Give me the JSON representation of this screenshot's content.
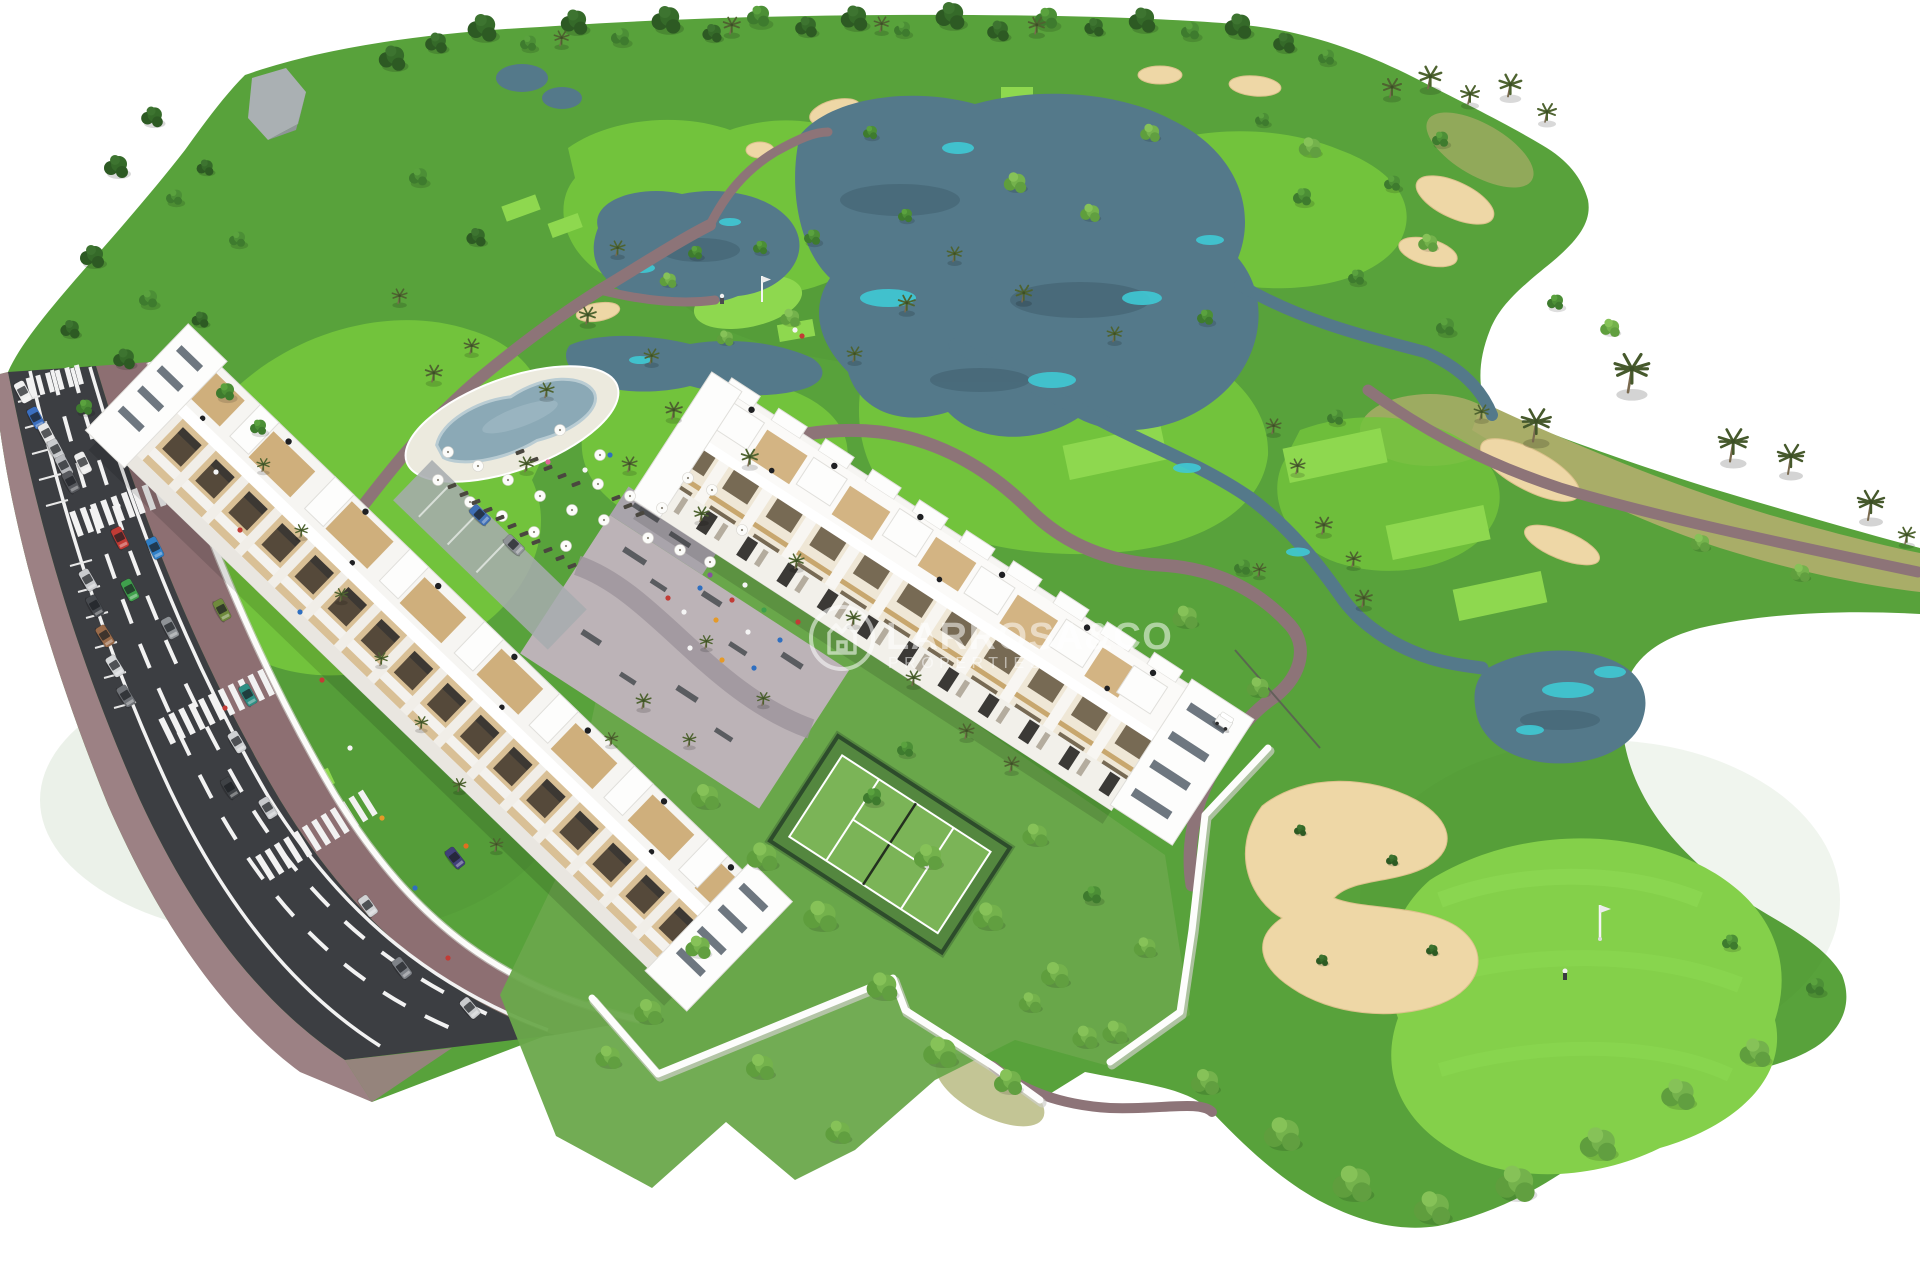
{
  "watermark": {
    "title": "LARROSA&CO",
    "subtitle": "PROPERTIES",
    "logo": "house-crown-circle-icon"
  },
  "palette": {
    "bg": "#ffffff",
    "rough": "#58a23b",
    "fairway": "#72c33c",
    "fairway2": "#84d04a",
    "tee": "#8ed84f",
    "dry": "#a9ad68",
    "water": "#54798a",
    "waterDeep": "#3c5a68",
    "cyan": "#3fc9d4",
    "sand": "#eed7a6",
    "sandEdge": "#dcc28c",
    "path": "#8d7478",
    "road": "#3c3e42",
    "roadLine": "#f2f2f2",
    "sidewalk": "#9c8184",
    "sidewalk2": "#8d6f72",
    "white": "#f6f5f2",
    "wood": "#cba76f",
    "garden": "#6aa84b",
    "playground": "#bcb3b7",
    "court": "#7bb457",
    "fence": "#2d4c2b",
    "wall": "#fdfdfc",
    "treeDark": "#2d5a23",
    "treeMid": "#3e7b2e",
    "treeLight": "#74b24c",
    "palm": "#4e6330",
    "pool": "#8ba9b6",
    "poolDeck": "#eceade"
  },
  "scene": {
    "trees": [
      [
        392,
        62,
        1.1,
        "t1"
      ],
      [
        436,
        46,
        0.9,
        "t1"
      ],
      [
        482,
        32,
        1.2,
        "t1"
      ],
      [
        528,
        46,
        0.8,
        "t2"
      ],
      [
        574,
        26,
        1.1,
        "t1"
      ],
      [
        620,
        40,
        0.9,
        "t2"
      ],
      [
        666,
        24,
        1.2,
        "t1"
      ],
      [
        712,
        36,
        0.8,
        "t1"
      ],
      [
        758,
        20,
        1.1,
        "t2"
      ],
      [
        806,
        30,
        0.9,
        "t1"
      ],
      [
        854,
        22,
        1.1,
        "t1"
      ],
      [
        902,
        32,
        0.8,
        "t2"
      ],
      [
        950,
        20,
        1.2,
        "t1"
      ],
      [
        998,
        34,
        0.9,
        "t1"
      ],
      [
        1046,
        22,
        1.1,
        "t2"
      ],
      [
        1094,
        30,
        0.8,
        "t1"
      ],
      [
        1142,
        24,
        1.1,
        "t1"
      ],
      [
        1190,
        34,
        0.9,
        "t2"
      ],
      [
        1238,
        30,
        1.1,
        "t1"
      ],
      [
        1284,
        46,
        0.9,
        "t1"
      ],
      [
        1326,
        60,
        0.8,
        "t2"
      ],
      [
        560,
        44,
        0.8,
        "palm"
      ],
      [
        730,
        32,
        0.9,
        "palm"
      ],
      [
        880,
        30,
        0.8,
        "palm"
      ],
      [
        1035,
        32,
        0.9,
        "palm"
      ],
      [
        1390,
        95,
        1.0,
        "palm"
      ],
      [
        1428,
        86,
        1.2,
        "palm"
      ],
      [
        1468,
        102,
        1.0,
        "palm"
      ],
      [
        1508,
        94,
        1.2,
        "palm"
      ],
      [
        1545,
        120,
        1.0,
        "palm"
      ],
      [
        152,
        120,
        0.9,
        "t1"
      ],
      [
        116,
        170,
        1.0,
        "t1"
      ],
      [
        174,
        200,
        0.8,
        "t2"
      ],
      [
        92,
        260,
        1.0,
        "t1"
      ],
      [
        148,
        302,
        0.9,
        "t2"
      ],
      [
        70,
        332,
        0.8,
        "t1"
      ],
      [
        124,
        362,
        0.9,
        "t1"
      ],
      [
        84,
        410,
        0.8,
        "t2"
      ],
      [
        205,
        170,
        0.7,
        "t1"
      ],
      [
        237,
        242,
        0.8,
        "t2"
      ],
      [
        200,
        322,
        0.7,
        "t1"
      ],
      [
        418,
        180,
        0.9,
        "t2"
      ],
      [
        476,
        240,
        0.8,
        "t1"
      ],
      [
        398,
        302,
        0.8,
        "palm"
      ],
      [
        616,
        254,
        0.8,
        "palm"
      ],
      [
        586,
        322,
        0.9,
        "palm"
      ],
      [
        650,
        362,
        0.8,
        "palm"
      ],
      [
        545,
        396,
        0.8,
        "palm"
      ],
      [
        760,
        250,
        0.7,
        "t2"
      ],
      [
        905,
        310,
        0.9,
        "palm"
      ],
      [
        953,
        260,
        0.8,
        "palm"
      ],
      [
        1022,
        300,
        0.9,
        "palm"
      ],
      [
        1113,
        340,
        0.8,
        "palm"
      ],
      [
        1205,
        320,
        0.8,
        "t2"
      ],
      [
        853,
        360,
        0.8,
        "palm"
      ],
      [
        1302,
        200,
        0.9,
        "t2"
      ],
      [
        1356,
        280,
        0.8,
        "t2"
      ],
      [
        1445,
        330,
        0.9,
        "t2"
      ],
      [
        1335,
        420,
        0.8,
        "t2"
      ],
      [
        905,
        218,
        0.7,
        "t2"
      ],
      [
        1392,
        186,
        0.8,
        "t2"
      ],
      [
        812,
        240,
        0.8,
        "t2"
      ],
      [
        1015,
        185,
        0.8,
        "bush"
      ],
      [
        1090,
        215,
        0.7,
        "bush"
      ],
      [
        695,
        255,
        0.7,
        "t2"
      ],
      [
        1150,
        135,
        0.7,
        "bush"
      ],
      [
        870,
        135,
        0.7,
        "t2"
      ],
      [
        790,
        320,
        0.7,
        "bush"
      ],
      [
        1533,
        437,
        1.1,
        "palmL"
      ],
      [
        1628,
        387,
        1.3,
        "palmL"
      ],
      [
        1730,
        457,
        1.1,
        "palmL"
      ],
      [
        1788,
        470,
        1.0,
        "palmL"
      ],
      [
        1868,
        516,
        1.0,
        "palmL"
      ],
      [
        1905,
        542,
        0.9,
        "palm"
      ],
      [
        1480,
        418,
        0.8,
        "palm"
      ],
      [
        1272,
        432,
        0.8,
        "palm"
      ],
      [
        1296,
        472,
        0.8,
        "palm"
      ],
      [
        1322,
        532,
        0.9,
        "palm"
      ],
      [
        1352,
        565,
        0.8,
        "palm"
      ],
      [
        1362,
        605,
        0.9,
        "palm"
      ],
      [
        1258,
        575,
        0.7,
        "palm"
      ],
      [
        1310,
        150,
        0.8,
        "bush"
      ],
      [
        1262,
        122,
        0.7,
        "t2"
      ],
      [
        1440,
        142,
        0.8,
        "t2"
      ],
      [
        1555,
        305,
        0.8,
        "t2"
      ],
      [
        1610,
        330,
        0.7,
        "bush"
      ],
      [
        1428,
        245,
        0.7,
        "bush"
      ],
      [
        1700,
        545,
        0.7,
        "bush"
      ],
      [
        1800,
        575,
        0.7,
        "bush"
      ],
      [
        432,
        380,
        0.9,
        "palm"
      ],
      [
        470,
        352,
        0.8,
        "palm"
      ],
      [
        525,
        470,
        0.8,
        "palm"
      ],
      [
        672,
        417,
        0.9,
        "palm"
      ],
      [
        628,
        470,
        0.8,
        "palm"
      ],
      [
        748,
        464,
        0.9,
        "palm"
      ],
      [
        700,
        520,
        0.8,
        "palm"
      ],
      [
        262,
        470,
        0.7,
        "palm"
      ],
      [
        300,
        536,
        0.7,
        "palm"
      ],
      [
        340,
        600,
        0.7,
        "palm"
      ],
      [
        380,
        664,
        0.7,
        "palm"
      ],
      [
        420,
        728,
        0.7,
        "palm"
      ],
      [
        458,
        790,
        0.7,
        "palm"
      ],
      [
        495,
        850,
        0.7,
        "palm"
      ],
      [
        225,
        395,
        0.9,
        "t2"
      ],
      [
        258,
        430,
        0.8,
        "t2"
      ],
      [
        795,
        567,
        0.8,
        "palm"
      ],
      [
        852,
        624,
        0.8,
        "palm"
      ],
      [
        912,
        684,
        0.8,
        "palm"
      ],
      [
        762,
        704,
        0.7,
        "palm"
      ],
      [
        705,
        647,
        0.7,
        "palm"
      ],
      [
        965,
        737,
        0.8,
        "palm"
      ],
      [
        1010,
        770,
        0.8,
        "palm"
      ],
      [
        642,
        707,
        0.8,
        "palm"
      ],
      [
        610,
        744,
        0.7,
        "palm"
      ],
      [
        688,
        745,
        0.7,
        "palm"
      ],
      [
        705,
        800,
        1.0,
        "bush"
      ],
      [
        762,
        860,
        1.1,
        "bush"
      ],
      [
        820,
        920,
        1.2,
        "bush"
      ],
      [
        882,
        990,
        1.1,
        "bush"
      ],
      [
        940,
        1056,
        1.2,
        "bush"
      ],
      [
        1008,
        1085,
        1.0,
        "bush"
      ],
      [
        872,
        800,
        0.9,
        "t2"
      ],
      [
        928,
        860,
        1.0,
        "bush"
      ],
      [
        988,
        920,
        1.1,
        "bush"
      ],
      [
        1055,
        978,
        1.0,
        "bush"
      ],
      [
        1115,
        1035,
        0.9,
        "bush"
      ],
      [
        698,
        950,
        0.9,
        "bush"
      ],
      [
        648,
        1015,
        1.0,
        "bush"
      ],
      [
        608,
        1060,
        0.9,
        "bush"
      ],
      [
        760,
        1070,
        1.0,
        "bush"
      ],
      [
        838,
        1135,
        0.9,
        "bush"
      ],
      [
        905,
        752,
        0.8,
        "t2"
      ],
      [
        1035,
        838,
        0.9,
        "bush"
      ],
      [
        1092,
        898,
        0.9,
        "t2"
      ],
      [
        1145,
        950,
        0.8,
        "bush"
      ],
      [
        1185,
        620,
        0.9,
        "bush"
      ],
      [
        1242,
        570,
        0.8,
        "t2"
      ],
      [
        1258,
        690,
        0.8,
        "bush"
      ],
      [
        1282,
        1138,
        1.3,
        "bush"
      ],
      [
        1352,
        1188,
        1.4,
        "bush"
      ],
      [
        1432,
        1212,
        1.3,
        "bush"
      ],
      [
        1515,
        1188,
        1.4,
        "bush"
      ],
      [
        1598,
        1148,
        1.3,
        "bush"
      ],
      [
        1678,
        1098,
        1.2,
        "bush"
      ],
      [
        1755,
        1056,
        1.1,
        "bush"
      ],
      [
        1815,
        990,
        0.9,
        "t2"
      ],
      [
        1730,
        945,
        0.8,
        "t2"
      ],
      [
        1205,
        1085,
        1.0,
        "bush"
      ],
      [
        1300,
        832,
        0.5,
        "t1"
      ],
      [
        1392,
        862,
        0.5,
        "t1"
      ],
      [
        1322,
        962,
        0.5,
        "t1"
      ],
      [
        1432,
        952,
        0.5,
        "t1"
      ],
      [
        1085,
        1040,
        0.9,
        "bush"
      ],
      [
        1030,
        1005,
        0.8,
        "bush"
      ],
      [
        668,
        282,
        0.6,
        "bush"
      ],
      [
        725,
        340,
        0.6,
        "bush"
      ]
    ],
    "cars": [
      [
        23,
        392,
        62,
        "#f0f0f0"
      ],
      [
        36,
        418,
        62,
        "#3b6fc0"
      ],
      [
        47,
        434,
        62,
        "#e8e8e8"
      ],
      [
        56,
        450,
        62,
        "#c9cbce"
      ],
      [
        64,
        466,
        62,
        "#b7b9bd"
      ],
      [
        71,
        482,
        62,
        "#56585d"
      ],
      [
        88,
        580,
        60,
        "#c9cbce"
      ],
      [
        95,
        606,
        60,
        "#474a4f"
      ],
      [
        105,
        636,
        58,
        "#9a6b4a"
      ],
      [
        115,
        666,
        58,
        "#d6d8da"
      ],
      [
        126,
        696,
        58,
        "#6f7277"
      ],
      [
        83,
        463,
        64,
        "#ededed"
      ],
      [
        120,
        538,
        63,
        "#c23b35"
      ],
      [
        155,
        548,
        63,
        "#2f7fc6"
      ],
      [
        130,
        590,
        62,
        "#3fa04c"
      ],
      [
        170,
        628,
        62,
        "#8e9296"
      ],
      [
        222,
        610,
        62,
        "#6f8a3d"
      ],
      [
        248,
        695,
        60,
        "#2e8f84"
      ],
      [
        237,
        742,
        59,
        "#cfd1d3"
      ],
      [
        230,
        788,
        58,
        "#3f4246"
      ],
      [
        268,
        808,
        58,
        "#c7c9cc"
      ],
      [
        368,
        906,
        54,
        "#d0d2d4"
      ],
      [
        402,
        968,
        53,
        "#7e8288"
      ],
      [
        455,
        858,
        52,
        "#41407a"
      ],
      [
        470,
        1008,
        50,
        "#caccce"
      ],
      [
        480,
        515,
        44,
        "#3f6fb5"
      ],
      [
        514,
        545,
        44,
        "#8f9397"
      ]
    ],
    "umbrellas": [
      [
        448,
        452
      ],
      [
        478,
        466
      ],
      [
        508,
        480
      ],
      [
        540,
        496
      ],
      [
        572,
        510
      ],
      [
        604,
        520
      ],
      [
        470,
        502
      ],
      [
        502,
        516
      ],
      [
        534,
        532
      ],
      [
        566,
        546
      ],
      [
        438,
        480
      ],
      [
        598,
        484
      ],
      [
        630,
        496
      ],
      [
        662,
        508
      ],
      [
        688,
        478
      ],
      [
        712,
        490
      ],
      [
        648,
        538
      ],
      [
        680,
        550
      ],
      [
        710,
        562
      ],
      [
        742,
        530
      ],
      [
        600,
        455
      ],
      [
        560,
        430
      ]
    ],
    "loungers": [
      [
        452,
        486
      ],
      [
        464,
        494
      ],
      [
        476,
        502
      ],
      [
        488,
        510
      ],
      [
        500,
        518
      ],
      [
        512,
        526
      ],
      [
        524,
        534
      ],
      [
        536,
        542
      ],
      [
        548,
        550
      ],
      [
        560,
        558
      ],
      [
        572,
        566
      ],
      [
        520,
        452
      ],
      [
        534,
        460
      ],
      [
        548,
        468
      ],
      [
        562,
        476
      ],
      [
        576,
        484
      ],
      [
        616,
        498
      ],
      [
        628,
        506
      ],
      [
        640,
        514
      ]
    ],
    "people": [
      [
        668,
        598,
        "#c23b35"
      ],
      [
        684,
        612,
        "#f5f5f5"
      ],
      [
        700,
        588,
        "#2f6fc0"
      ],
      [
        716,
        620,
        "#e59a28"
      ],
      [
        732,
        600,
        "#c23b35"
      ],
      [
        748,
        632,
        "#f5f5f5"
      ],
      [
        764,
        610,
        "#3fa04c"
      ],
      [
        780,
        640,
        "#2f6fc0"
      ],
      [
        798,
        622,
        "#c23b35"
      ],
      [
        690,
        648,
        "#f5f5f5"
      ],
      [
        722,
        660,
        "#e59a28"
      ],
      [
        754,
        668,
        "#2f6fc0"
      ],
      [
        710,
        575,
        "#8850a0"
      ],
      [
        745,
        585,
        "#f5f5f5"
      ],
      [
        300,
        612,
        "#2f6fc0"
      ],
      [
        322,
        680,
        "#c23b35"
      ],
      [
        350,
        748,
        "#f5f5f5"
      ],
      [
        382,
        818,
        "#e59a28"
      ],
      [
        415,
        888,
        "#2f6fc0"
      ],
      [
        448,
        958,
        "#c23b35"
      ],
      [
        466,
        846,
        "#e07020"
      ],
      [
        216,
        472,
        "#f5f5f5"
      ],
      [
        240,
        530,
        "#c23b35"
      ],
      [
        118,
        506,
        "#f5f5f5"
      ],
      [
        225,
        708,
        "#c23b35"
      ],
      [
        548,
        462,
        "#e0659a"
      ],
      [
        585,
        470,
        "#f5f5f5"
      ],
      [
        610,
        455,
        "#2f6fc0"
      ],
      [
        795,
        330,
        "#f5f5f5"
      ],
      [
        802,
        336,
        "#c23b35"
      ]
    ]
  }
}
